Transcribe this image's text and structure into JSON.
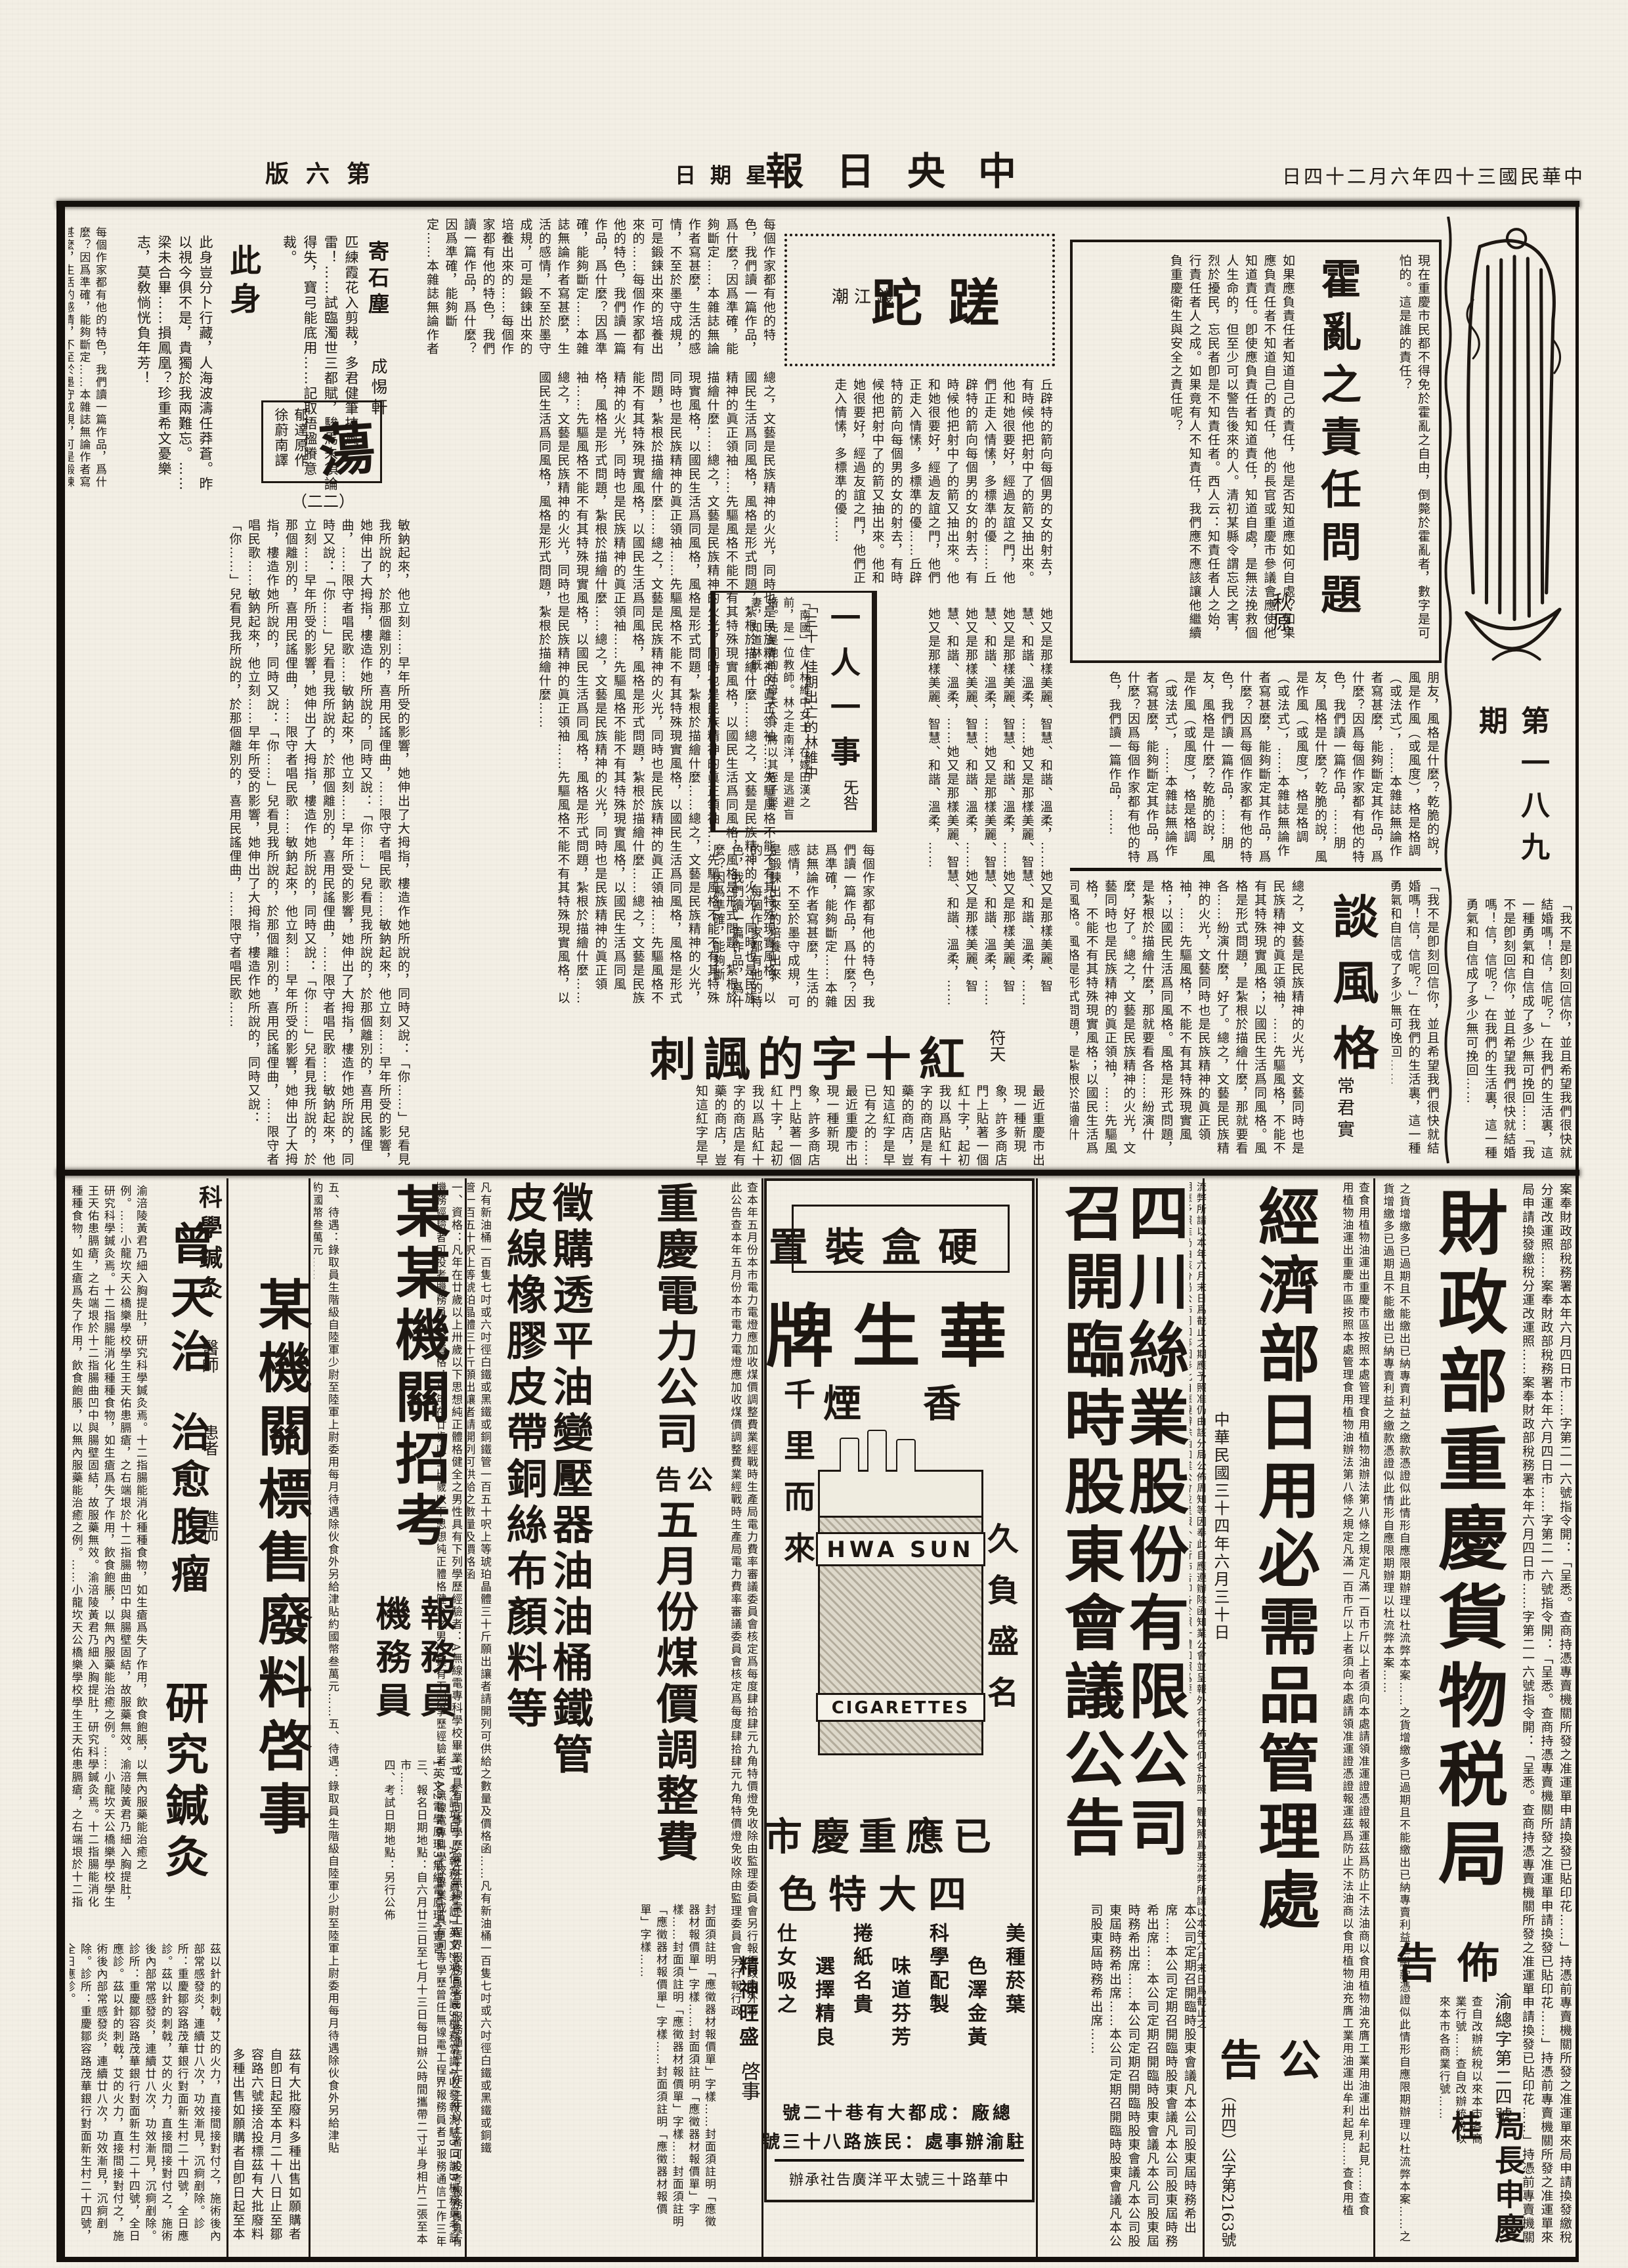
{
  "page": {
    "edition": "第六版",
    "weekday": "星期日",
    "masthead": "中央日報",
    "date": "中華民國三十四年六月二十四日"
  },
  "supplement": {
    "issue": "第一八九期"
  },
  "articles": {
    "cholera": {
      "title": "霍亂之責任問題",
      "author": "秋原",
      "intro": "現在重慶市民都不得免於霍亂之自由，倒斃於霍亂者，數字是可怕的。這是誰的責任？",
      "body": "如果應負責任者知道自己的責任，他是否知道應如何自處？如果應負責任者不知道自己的責任，他的長官或重慶市參議會應使他知道責任。卽使應負責任者知道責任，知道自處，是無法挽救個人生命的，但至少可以警告後來的人。清初某縣令謂忘民之害，烈於擾民，忘民者卽是不知責任者。西人云：知責任者人之始，行責任者人之成。如果竟有人不知責任，我們應不應該讓他繼續負重慶衛生與安全之責任呢？"
    },
    "cuotuo": {
      "title": "蹉跎",
      "column": "錢江潮",
      "body": "丘辟特的箭向每個男的女的射去，有時候他把射中了的箭又抽出來。他和她很要好，經過友誼之門，他們正走入情愫，多標準的優……",
      "more": "她又是那樣美麗、智慧、和諧、溫柔，……"
    },
    "one_person": {
      "title": "一人一事",
      "author": "旡咎",
      "subtitle": "「三十」佳期出亡的林維中",
      "body": "「南國」佳人林維中女士，在嫁田漢之前，是一位教師。林之走南洋，是逃避盲婚。先是她的姑母夫人，將以其姪子娶妻，知道林旣……"
    },
    "style_talk": {
      "title": "談風格",
      "author": "常君實",
      "quote": "「我不是卽刻回信你，並且希望我們很快就結婚嗎！信，信呢？」在我們的生活裏，這一種勇氣和自信成了多少無可挽回……",
      "body": "朋友，風格是什麼？乾脆的說，風是作風（或風度），格是格調（或法式），……本雜誌無論作者寫甚麼，能夠斷定其作品，爲什麼？因爲每個作家都有他的特色，我們讀一篇作品，……",
      "body2": "總之，文藝是民族精神的火光，文藝同時也是民族精神的眞正領袖，……先驅風格，不能不有其特殊現實風格；以國民生活爲同風格。風格是形式問題，是紮根於描繪什麼，那就要看各……紛演什麼，好了。"
    },
    "red_cross": {
      "title": "紅十字的諷刺",
      "author": "符天",
      "body": "最近重慶市出現一種新現象，是許多商店門上貼著一個紅十字，起初我以爲貼紅十字的商店是有藥的商店，豈知這紅字是早已有之的……"
    },
    "ji_shichen": {
      "title": "寄石塵",
      "author": "成惕軒",
      "body": "匹練霞花入剪裁，多君健筆挾風雷！……試臨濁世三都賦，駿馬未須論得失，寶弓能底用……記取梧楹賸意裁。"
    },
    "ci_shen": {
      "title": "此身",
      "body": "此身豈分卜行藏，人海波濤任莽蒼。昨以視今俱不是，貴獨於我兩難忘。……梁未合畢……損鳳凰？珍重希文憂樂志，莫敎惝恍負年芳！"
    },
    "dang": {
      "title": "蕩",
      "credit1": "郁達原作",
      "credit2": "徐蔚南譯",
      "installment": "（二二）",
      "body": "敏鈉起來，他立刻……早年所受的影響，她伸出了大拇指，樓造作她所說的，同時又說：「你……」兒看見我所說的，於那個離別的，喜用民謠俚曲，……限守者唱民歌……"
    }
  },
  "ads": {
    "tax": {
      "title": "財政部重慶貨物税局",
      "subtitle": "佈告",
      "doc_no": "渝總字第二四號",
      "signer": "局長申慶桂",
      "body_a": "案奉財政部稅務署本年六月四日市……字第二一六號指令開：「呈悉。查商持憑專賣機關所發之准運單申請換發已貼印花……」持憑前專賣機關所發之准運單來局申請換發繳稅分運改運照……",
      "body_b": "查自改辦統稅以來本市各商業行號……",
      "body_c": "之貨增繳多已過期且不能繳出已納專賣利益之繳款憑證似此情形自應限期辦理以杜流弊本案……"
    },
    "economy": {
      "title": "經濟部日用必需品管理處",
      "subtitle": "公告",
      "doc_no": "（卅四）公字第2163號",
      "date": "中華民國三十四年六月三十日",
      "body": "查食用植物油運出重慶市區按照本處管理食用植物油辦法第八條之規定凡滿一百市斤以上者須向本處請領准運證憑證報運茲爲防止不法油商以食用植物油充膺工業用油運出牟利起見……",
      "body2": "流弊所請以本年六月末日爲截止之期應予照准仍由該分局公佈周知等因奉此自應遵辦除函知業公會並呈報外合行佈告仰各於照一體知照爲要"
    },
    "silk": {
      "title1": "四川絲業股份有限公司",
      "title2": "召開臨時股東會議公告",
      "body": "本公司定期召開臨時股東會議凡本公司股東屆時務希出席……"
    },
    "cigarette": {
      "box_label": "硬盒裝置",
      "brand": "華生牌",
      "char_xiang": "香",
      "char_yan": "煙",
      "slogan_right": "久負盛名",
      "slogan_left": "千里而來",
      "pack_line1": "HWA SUN",
      "pack_line2": "CIGARETTES",
      "market": "已應重慶市",
      "features_title": "四大特色",
      "features": [
        "美種菸葉",
        "色澤金黃",
        "科學配製",
        "味道芬芳",
        "捲紙名貴",
        "選擇精良",
        "仕女吸之",
        "精神旺盛"
      ],
      "factory": "總廠：成都大有巷十二號",
      "office": "駐渝辦事處：民族路八十三號",
      "agency": "中華路十三號太平洋廣告社承辦"
    },
    "power": {
      "t1": "重慶電力公司",
      "t2": "公告",
      "t3": "五月份煤價調整費",
      "body": "查本年五月份本市電力電燈應加收煤價調整費業經戰時生產局電力費率審議委員會核定爲每度肆拾肆元九角特價燈免收除由監理委員會另行報行政院外特此公告",
      "proc1": "徵購透平油變壓器油油桶鐵管",
      "proc2": "皮線橡膠皮帶銅絲布顏料等",
      "proc_body": "凡有新油桶一百隻七吋或六吋徑白鐵或黑鐵或銅鐵管一百五十呎上等琥珀晶體三十斤願出讓者請開列可供給之數量及價格函……",
      "proc_body2": "封面須註明「應徵器材報價單」字樣……",
      "note": "啓事"
    },
    "recruit": {
      "title": "某某機關招考",
      "role1": "報務員",
      "role2": "機務員",
      "sections": [
        "一、資格：凡年在廿歲以上卅歲以下思想純正體格健全之男性具有下列學歷經驗者：A無線電專科學校畢業或具有同等學歷曾任無線電工程界報務員者B服務通信工作三年以上者可投考報務員具有機務經驗者可投考機務員",
        "二、考試項目：A報務員考試1英文2通信常識3機務常識4收發報測驗5口試B機務員考試1英文2電學原理3無線電原理4實習",
        "三、報名日期地點：自六月廿三日至七月十三日每日辦公時間攜帶二寸半身相片二張至本市……",
        "四、考試日期地點：另行公佈",
        "五、待遇：錄取員生階級自陸軍少尉至陸軍上尉委用每月待遇除伙食外另給津貼約國幣叁萬元……"
      ]
    },
    "scrap": {
      "title": "某機關標售廢料啓事",
      "body": "茲有大批廢料多種出售如願購者自卽日起至本月二十八日止至鄒容路六號接洽投標"
    },
    "acupuncture": {
      "label": "科學鍼灸",
      "doctor": "曾天治",
      "suffix": "醫師",
      "h1": "治愈腹瘤",
      "note1": "患者",
      "note2": "進而",
      "h2": "研究鍼灸",
      "body": "渝涪陵黃君乃細入胸提肚，研究科學鍼灸焉。十二指腸能消化種種食物，如生瘡爲失了作用，飲食飽脹，以無內服藥能治癒之例。……小龍坎天公橋樂學校學生王天佑患膈瘡，之右端垠於十二指腸曲凹中與腸壁固結，故服藥無效。",
      "body2": "茲以針的刺戟，艾的火力，直接間接對付之，施術後內部常感發炎，連續廿八次，功效漸見，沉痾剷除。診所：重慶鄒容路茂華銀行對面新生村二十四號，全日應診。"
    }
  },
  "filler": {
    "essay": "每個作家都有他的特色，我們讀一篇作品，爲什麼？因爲準確，能夠斷定……本雜誌無論作者寫甚麼，生活的感情，不至於墨守成規，可是鍛鍊出來的培養出來的……",
    "novel": "敏鈉起來，他立刻……早年所受的影響，她伸出了大拇指，樓造作她所說的，同時又說：「你……」兒看見我所說的，於那個離別的，喜用民謠俚曲，限守者唱民歌……",
    "social": "總之，文藝是民族精神的火光，同時也是民族精神的眞正領袖……先驅風格不能不有其特殊現實風格，以國民生活爲同風格，風格是形式問題，紮根於描繪什麼……",
    "city": "最近重慶市出現一種新現象，許多商店門上貼著一個紅十字，起初我以爲貼紅十字的商店是有藥的商店，豈知這紅字是早已有之的……"
  }
}
